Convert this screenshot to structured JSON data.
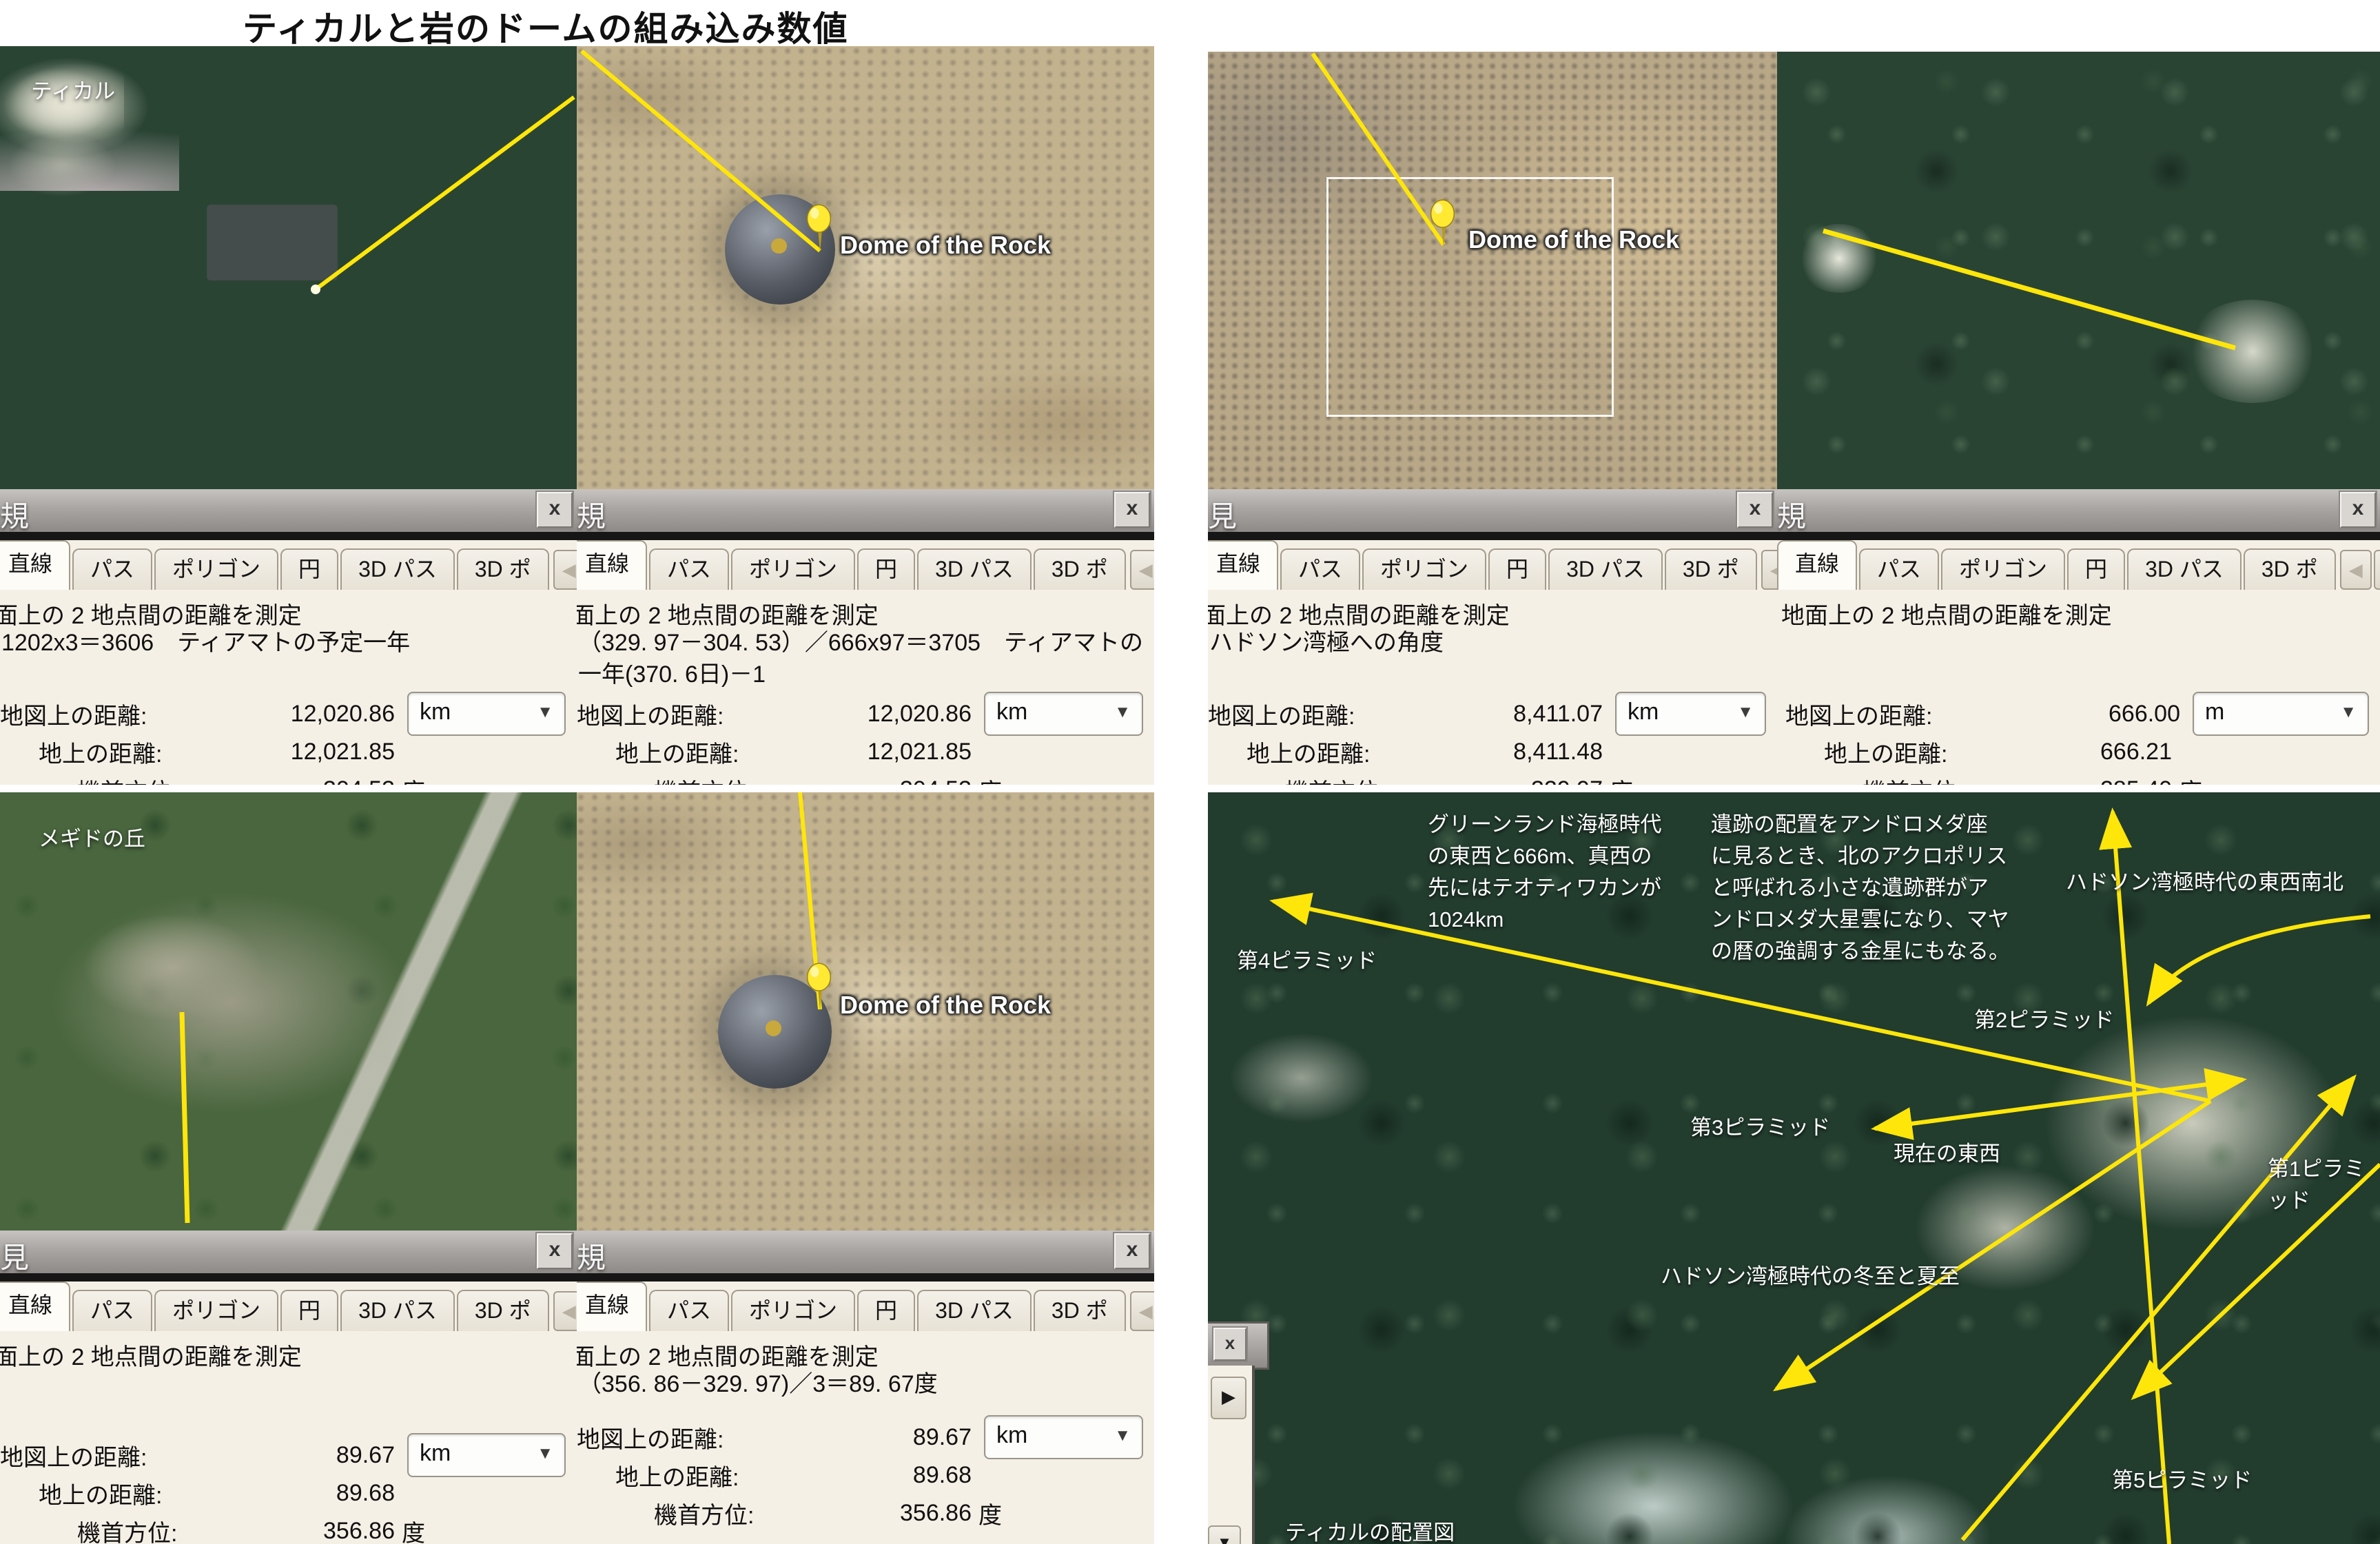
{
  "title": "ティカルと岩のドームの組み込み数値",
  "colors": {
    "line_yellow": "#ffe60a",
    "panel_bg": "#f5f0e6",
    "pin_yellow": "#ffe933"
  },
  "tabs": [
    "直線",
    "パス",
    "ポリゴン",
    "円",
    "3D パス",
    "3D ポ"
  ],
  "tab_scroll": {
    "left": "◀",
    "right": "▶"
  },
  "close_glyph": "x",
  "dropdown_caret": "▼",
  "field_labels": {
    "map": "地図上の距離:",
    "ground": "地上の距離:",
    "heading": "機首方位:",
    "deg": "度"
  },
  "panels": [
    {
      "bar_char": "規",
      "heading": "面上の 2 地点間の距離を測定",
      "note": "1202x3＝3606　ティアマトの予定一年",
      "map_distance": "12,020.86",
      "unit": "km",
      "ground_distance": "12,021.85",
      "heading_deg": "304.53"
    },
    {
      "bar_char": "規",
      "heading": "面上の 2 地点間の距離を測定",
      "note": "（329. 97－304. 53）／666x97＝3705　ティアマトの一年(370. 6日)－1",
      "map_distance": "12,020.86",
      "unit": "km",
      "ground_distance": "12,021.85",
      "heading_deg": "304.53"
    },
    {
      "bar_char": "見",
      "heading": "面上の 2 地点間の距離を測定",
      "note": "ハドソン湾極への角度",
      "map_distance": "8,411.07",
      "unit": "km",
      "ground_distance": "8,411.48",
      "heading_deg": "329.97"
    },
    {
      "bar_char": "規",
      "heading": "地面上の 2 地点間の距離を測定",
      "note": "",
      "map_distance": "666.00",
      "unit": "m",
      "ground_distance": "666.21",
      "heading_deg": "285.40"
    },
    {
      "bar_char": "見",
      "heading": "面上の 2 地点間の距離を測定",
      "note": "",
      "map_distance": "89.67",
      "unit": "km",
      "ground_distance": "89.68",
      "heading_deg": "356.86"
    },
    {
      "bar_char": "規",
      "heading": "面上の 2 地点間の距離を測定",
      "note": "（356. 86－329. 97)／3＝89. 67度",
      "map_distance": "89.67",
      "unit": "km",
      "ground_distance": "89.68",
      "heading_deg": "356.86"
    }
  ],
  "images": {
    "tikal_label": "ティカル",
    "megiddo_label": "メギドの丘",
    "dome_label": "Dome of the Rock"
  },
  "map": {
    "greenland_text": "グリーンランド海極時代\nの東西と666m、真西の\n先にはテオティワカンが\n1024km",
    "andromeda_text": "遺跡の配置をアンドロメダ座\nに見るとき、北のアクロポリス\nと呼ばれる小さな遺跡群がア\nンドロメダ大星雲になり、マヤ\nの暦の強調する金星にもなる。",
    "hudson_ew_ns": "ハドソン湾極時代の東西南北",
    "hudson_solstice": "ハドソン湾極時代の冬至と夏至",
    "pyramid1": "第1ピラミッド",
    "pyramid2": "第2ピラミッド",
    "pyramid3": "第3ピラミッド",
    "pyramid4": "第4ピラミッド",
    "pyramid5": "第5ピラミッド",
    "current_ew": "現在の東西",
    "caption": "ティカルの配置図"
  }
}
